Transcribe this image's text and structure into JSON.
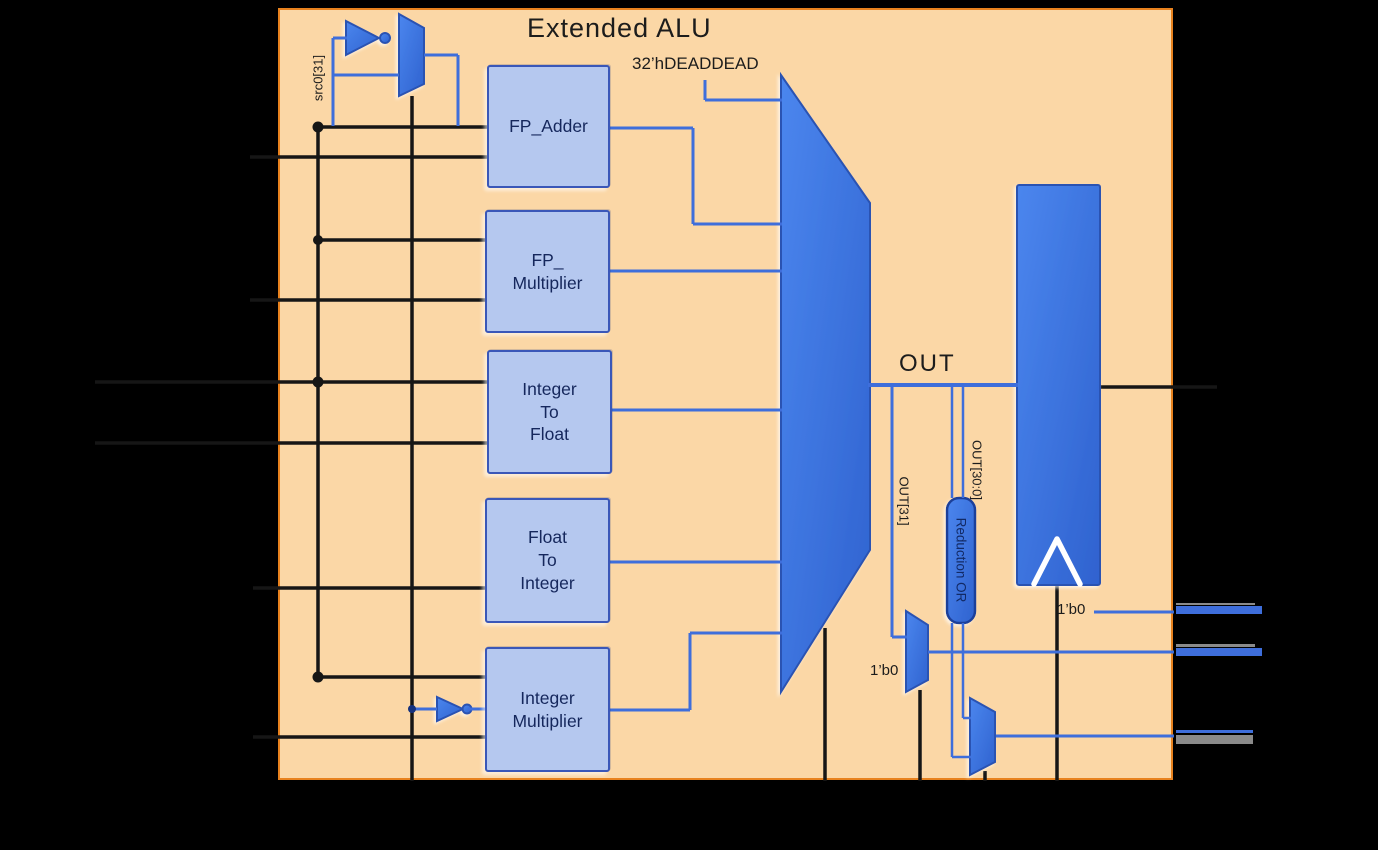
{
  "diagram": {
    "title": "Extended ALU",
    "constant_label": "32’hDEADDEAD",
    "out_label": "OUT",
    "src0_bit_label": "src0[31]",
    "out_bit31_label": "OUT[31]",
    "out_bits30_label": "OUT[30:0]",
    "reduction_or_label": "Reduction OR",
    "mux_tie_low_label": "1’b0",
    "flag_tie_low_label": "1’b0",
    "units": [
      {
        "label": "FP_Adder"
      },
      {
        "label": "FP_\nMultiplier"
      },
      {
        "label": "Integer\nTo\nFloat"
      },
      {
        "label": "Float\nTo\nInteger"
      },
      {
        "label": "Integer\nMultiplier"
      }
    ],
    "colors": {
      "background": "#000000",
      "panel": "#fbd7a6",
      "panel_border": "#e8821e",
      "shape_blue": "#3d76e0",
      "unit_fill": "#b5c8ef",
      "unit_border": "#3a57b8",
      "wire_blue": "#3e6edb",
      "wire_black": "#161616",
      "text_dark": "#1c1c1c",
      "unit_text": "#15275c"
    }
  }
}
